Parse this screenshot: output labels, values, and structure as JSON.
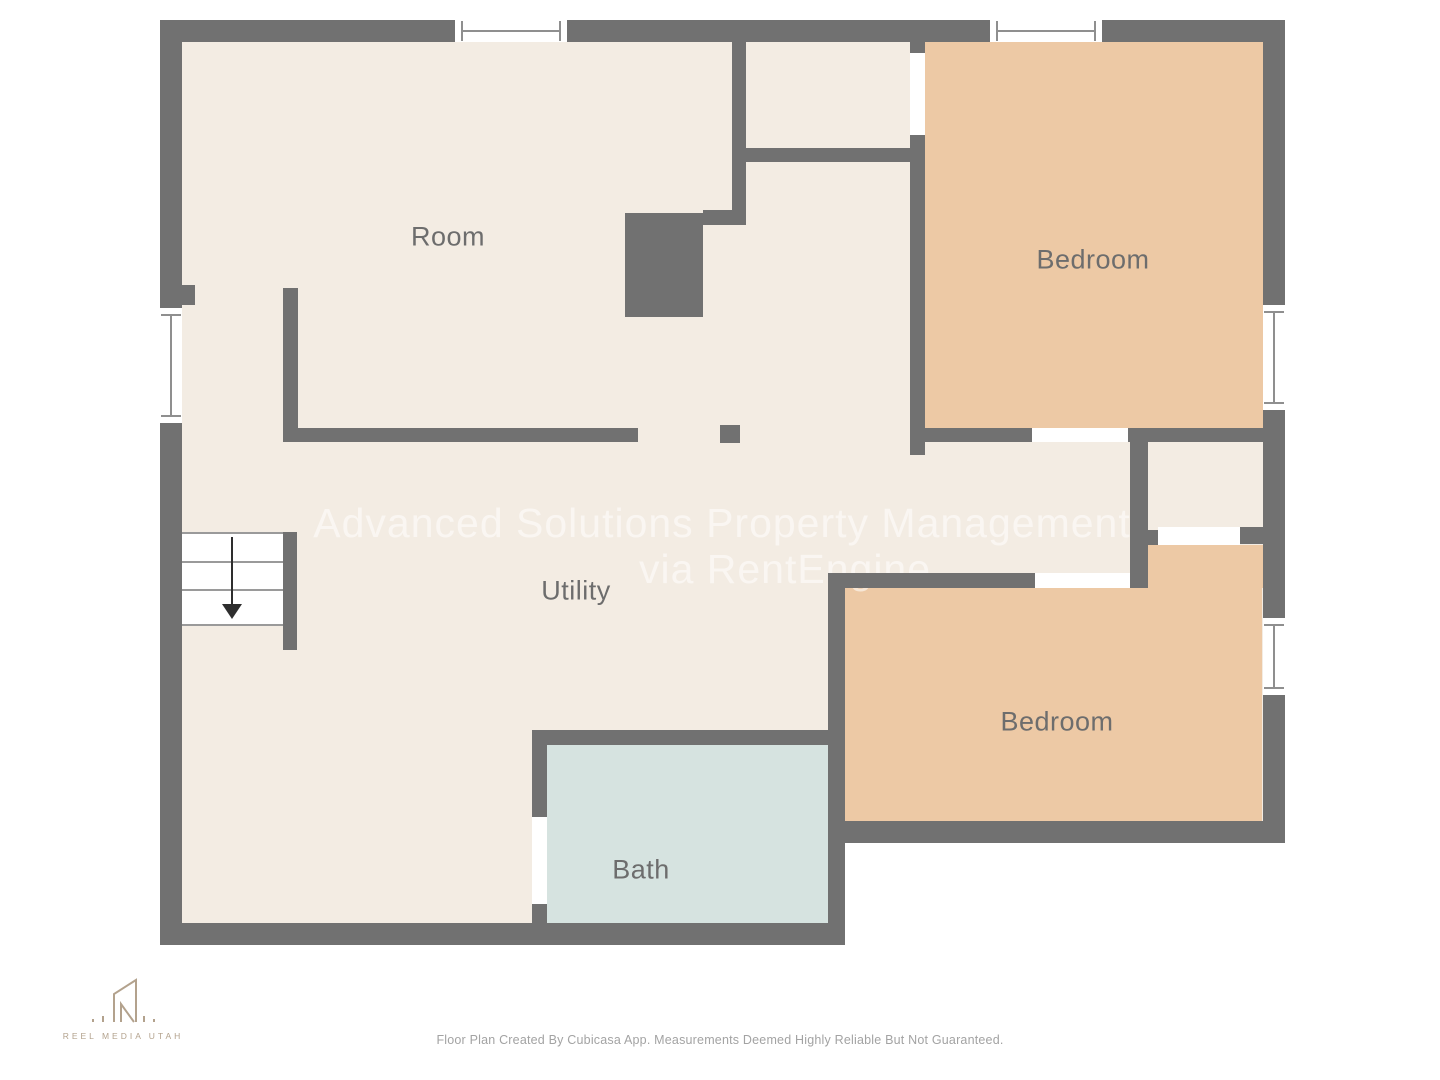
{
  "rooms": [
    {
      "name": "room",
      "label": "Room"
    },
    {
      "name": "bedroom-top",
      "label": "Bedroom"
    },
    {
      "name": "utility",
      "label": "Utility"
    },
    {
      "name": "bedroom-bottom",
      "label": "Bedroom"
    },
    {
      "name": "bath",
      "label": "Bath"
    }
  ],
  "watermark": {
    "line1": "Advanced Solutions Property Management",
    "line2": "via RentEngine"
  },
  "branding": {
    "logo_text": "REEL MEDIA UTAH"
  },
  "footer": {
    "disclaimer": "Floor Plan Created By Cubicasa App. Measurements Deemed Highly Reliable But Not Guaranteed."
  },
  "colors": {
    "bg": "#ffffff",
    "wall": "#717171",
    "floor": "#f3ece3",
    "bedroom": "#edc9a5",
    "bath": "#d6e3e0",
    "label": "#6d6d6d",
    "logo": "#b3a28d"
  }
}
